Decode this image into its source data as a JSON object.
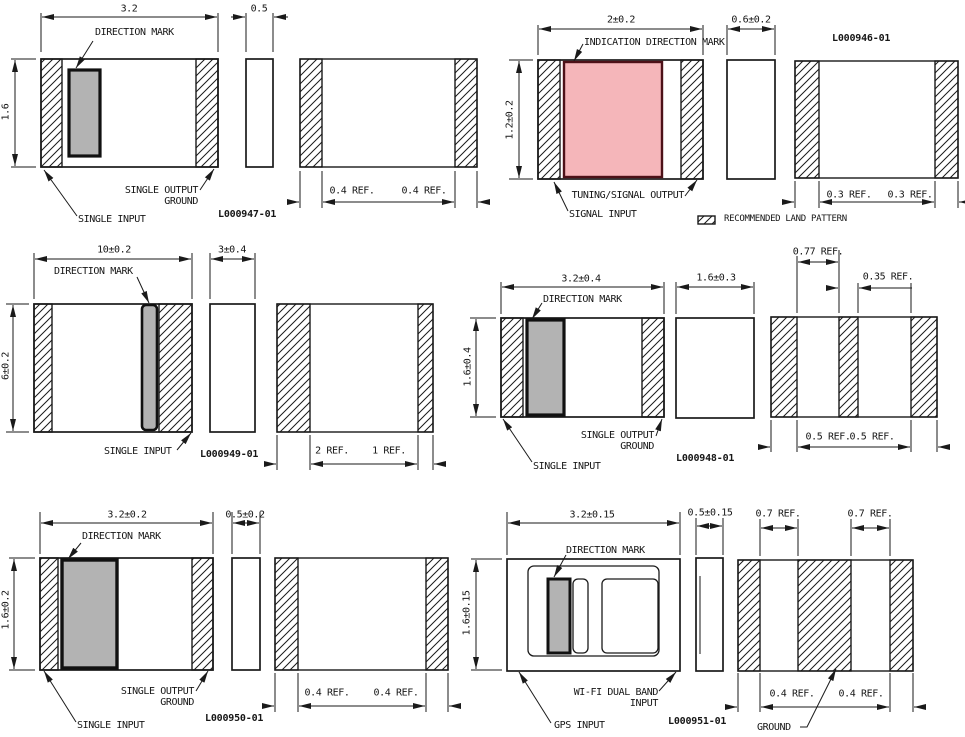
{
  "legend": {
    "label": "RECOMMENDED LAND PATTERN"
  },
  "colors": {
    "line": "#1a1a1a",
    "direction_mark_gray": "#b3b3b3",
    "indication_mark_fill": "#f5b6ba",
    "indication_mark_border": "#4d1118"
  },
  "panels": {
    "p947": {
      "part": "L000947-01",
      "width": "3.2",
      "thickness": "0.5",
      "height": "1.6",
      "pad_left": "0.4 REF.",
      "pad_right": "0.4 REF.",
      "mark": "DIRECTION MARK",
      "out1": "SINGLE OUTPUT",
      "out2": "GROUND",
      "input": "SINGLE INPUT"
    },
    "p946": {
      "part": "L000946-01",
      "width": "2±0.2",
      "thickness": "0.6±0.2",
      "height": "1.2±0.2",
      "pad_left": "0.3 REF.",
      "pad_right": "0.3 REF.",
      "mark": "INDICATION DIRECTION MARK",
      "out": "TUNING/SIGNAL OUTPUT",
      "input": "SIGNAL INPUT"
    },
    "p949": {
      "part": "L000949-01",
      "width": "10±0.2",
      "thickness": "3±0.4",
      "height": "6±0.2",
      "pad_left": "2 REF.",
      "pad_right": "1 REF.",
      "mark": "DIRECTION MARK",
      "input": "SINGLE INPUT"
    },
    "p948": {
      "part": "L000948-01",
      "width": "3.2±0.4",
      "thickness": "1.6±0.3",
      "height": "1.6±0.4",
      "gap": "0.77 REF.",
      "center_pad": "0.35 REF.",
      "pad_left": "0.5 REF.",
      "pad_right": "0.5 REF.",
      "mark": "DIRECTION MARK",
      "out1": "SINGLE OUTPUT",
      "out2": "GROUND",
      "input": "SINGLE INPUT"
    },
    "p950": {
      "part": "L000950-01",
      "width": "3.2±0.2",
      "thickness": "0.5±0.2",
      "height": "1.6±0.2",
      "pad_left": "0.4 REF.",
      "pad_right": "0.4 REF.",
      "mark": "DIRECTION MARK",
      "out1": "SINGLE OUTPUT",
      "out2": "GROUND",
      "input": "SINGLE INPUT"
    },
    "p951": {
      "part": "L000951-01",
      "width": "3.2±0.15",
      "thickness": "0.5±0.15",
      "height": "1.6±0.15",
      "gap_left": "0.7 REF.",
      "gap_right": "0.7 REF.",
      "pad_left": "0.4 REF.",
      "pad_right": "0.4 REF.",
      "mark": "DIRECTION MARK",
      "wifi1": "WI-FI DUAL BAND",
      "wifi2": "INPUT",
      "gps": "GPS INPUT",
      "ground": "GROUND"
    }
  }
}
